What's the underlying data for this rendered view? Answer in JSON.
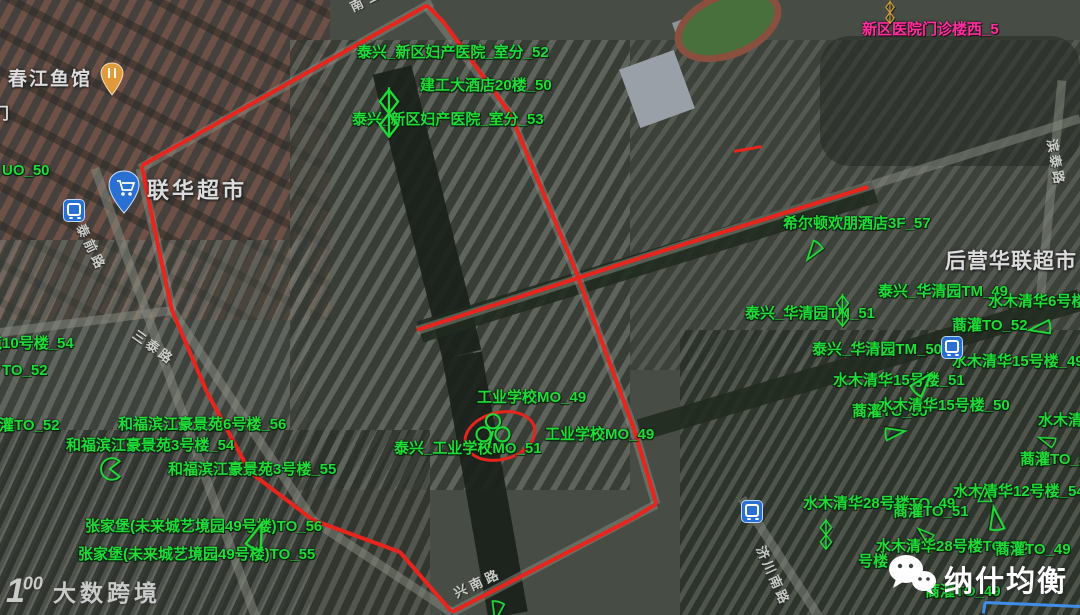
{
  "watermarks": {
    "bottom_left": {
      "logo": "1",
      "logo_sup": "00",
      "text": "大数跨境"
    },
    "bottom_right": {
      "icon": "wechat-icon",
      "text": "纳什均衡"
    }
  },
  "site_labels": [
    {
      "t": "泰兴_新区妇产医院_室分_52",
      "x": 357,
      "y": 45,
      "c": "g"
    },
    {
      "t": "建工大酒店20楼_50",
      "x": 420,
      "y": 78,
      "c": "g"
    },
    {
      "t": "泰兴_新区妇产医院_室分_53",
      "x": 352,
      "y": 112,
      "c": "g"
    },
    {
      "t": "新区医院门诊楼西_5",
      "x": 862,
      "y": 22,
      "c": "p"
    },
    {
      "t": "UO_50",
      "x": 2,
      "y": 163,
      "c": "g"
    },
    {
      "t": "苑10号楼_54",
      "x": -13,
      "y": 336,
      "c": "g"
    },
    {
      "t": "TO_52",
      "x": 2,
      "y": 363,
      "c": "g"
    },
    {
      "t": "蔏灌TO_52",
      "x": -16,
      "y": 418,
      "c": "g"
    },
    {
      "t": "和福滨江豪景苑6号楼_56",
      "x": 118,
      "y": 417,
      "c": "g"
    },
    {
      "t": "和福滨江豪景苑3号楼_54",
      "x": 66,
      "y": 438,
      "c": "g"
    },
    {
      "t": "和福滨江豪景苑3号楼_55",
      "x": 168,
      "y": 462,
      "c": "g"
    },
    {
      "t": "张家堡(未来城艺境园49号楼)TO_56",
      "x": 85,
      "y": 519,
      "c": "g"
    },
    {
      "t": "张家堡(未来城艺境园49号楼)TO_55",
      "x": 78,
      "y": 547,
      "c": "g"
    },
    {
      "t": "工业学校MO_49",
      "x": 477,
      "y": 390,
      "c": "g"
    },
    {
      "t": "工业学校MO_49",
      "x": 545,
      "y": 427,
      "c": "g"
    },
    {
      "t": "泰兴_工业学校MO_51",
      "x": 394,
      "y": 441,
      "c": "g"
    },
    {
      "t": "希尔顿欢朋酒店3F_57",
      "x": 783,
      "y": 216,
      "c": "g"
    },
    {
      "t": "泰兴_华清园TM_49",
      "x": 878,
      "y": 284,
      "c": "g"
    },
    {
      "t": "水木清华6号楼_49",
      "x": 988,
      "y": 294,
      "c": "g"
    },
    {
      "t": "泰兴_华清园TM_51",
      "x": 745,
      "y": 306,
      "c": "g"
    },
    {
      "t": "蔏灌TO_52",
      "x": 952,
      "y": 318,
      "c": "g"
    },
    {
      "t": "泰兴_华清园TM_50",
      "x": 812,
      "y": 342,
      "c": "g"
    },
    {
      "t": "水木清华15号楼_49",
      "x": 952,
      "y": 354,
      "c": "g"
    },
    {
      "t": "水木清华15号楼_51",
      "x": 833,
      "y": 373,
      "c": "g"
    },
    {
      "t": "蔏灌TO_50",
      "x": 852,
      "y": 404,
      "c": "g"
    },
    {
      "t": "水木清华15号楼_50",
      "x": 878,
      "y": 398,
      "c": "g"
    },
    {
      "t": "水木清华",
      "x": 1038,
      "y": 413,
      "c": "g"
    },
    {
      "t": "蔏灌TO_53",
      "x": 1020,
      "y": 452,
      "c": "g"
    },
    {
      "t": "水木清华12号楼_54",
      "x": 953,
      "y": 484,
      "c": "g"
    },
    {
      "t": "水木清华28号楼TO_49",
      "x": 803,
      "y": 496,
      "c": "g"
    },
    {
      "t": "蔏灌TO_51",
      "x": 893,
      "y": 504,
      "c": "g"
    },
    {
      "t": "水木清华28号楼TO_50",
      "x": 876,
      "y": 539,
      "c": "g"
    },
    {
      "t": "蔏灌TO_49",
      "x": 995,
      "y": 542,
      "c": "g"
    },
    {
      "t": "号楼",
      "x": 858,
      "y": 554,
      "c": "g"
    },
    {
      "t": "蔏灌TO_49",
      "x": 925,
      "y": 584,
      "c": "g"
    }
  ],
  "poi_labels": [
    {
      "t": "春江鱼馆",
      "x": 8,
      "y": 70,
      "fs": 19,
      "ls": 2
    },
    {
      "t": "门",
      "x": -7,
      "y": 106,
      "fs": 16,
      "ls": 0
    },
    {
      "t": "联华超市",
      "x": 147,
      "y": 179,
      "fs": 22,
      "ls": 3
    },
    {
      "t": "后营华联超市",
      "x": 945,
      "y": 250,
      "fs": 21,
      "ls": 1
    }
  ],
  "road_labels": [
    {
      "t": "南二环路",
      "x": 348,
      "y": 2,
      "rot": -26,
      "ls": 6
    },
    {
      "t": "泰前路",
      "x": 86,
      "y": 222,
      "rot": 64,
      "ls": 4
    },
    {
      "t": "三泰路",
      "x": 138,
      "y": 328,
      "rot": 36,
      "ls": 3
    },
    {
      "t": "兴南路",
      "x": 452,
      "y": 588,
      "rot": -25,
      "ls": 4
    },
    {
      "t": "济川南路",
      "x": 766,
      "y": 544,
      "rot": 66,
      "ls": 3
    },
    {
      "t": "滨泰路",
      "x": 1058,
      "y": 138,
      "rot": 80,
      "ls": 3
    }
  ],
  "route": {
    "color": "#e8251d",
    "loop": [
      [
        427,
        6
      ],
      [
        142,
        166
      ],
      [
        157,
        240
      ],
      [
        172,
        310
      ],
      [
        207,
        392
      ],
      [
        250,
        472
      ],
      [
        313,
        520
      ],
      [
        400,
        552
      ],
      [
        452,
        612
      ],
      [
        630,
        520
      ],
      [
        656,
        504
      ],
      [
        634,
        430
      ],
      [
        575,
        270
      ],
      [
        510,
        114
      ],
      [
        443,
        22
      ],
      [
        427,
        6
      ]
    ],
    "spur": [
      [
        417,
        330
      ],
      [
        640,
        258
      ],
      [
        868,
        187
      ]
    ],
    "tick": [
      [
        734,
        151
      ],
      [
        762,
        146
      ]
    ],
    "ellipse": {
      "cx": 497,
      "cy": 433,
      "rx": 34,
      "ry": 22,
      "rot": -14
    }
  },
  "measure_line": {
    "color": "#3f8fe8",
    "points": [
      [
        983,
        613
      ],
      [
        985,
        602
      ],
      [
        1080,
        606
      ]
    ]
  },
  "map_features": {
    "road_color": "rgba(138,142,132,0.5)",
    "water_color": "rgba(26,33,27,0.92)",
    "tree_color": "rgba(32,42,30,0.88)",
    "roads": [
      [
        [
          432,
          2
        ],
        [
          140,
          168
        ]
      ],
      [
        [
          140,
          168
        ],
        [
          172,
          310
        ]
      ],
      [
        [
          172,
          310
        ],
        [
          313,
          520
        ]
      ],
      [
        [
          313,
          520
        ],
        [
          452,
          612
        ]
      ],
      [
        [
          452,
          612
        ],
        [
          656,
          504
        ]
      ],
      [
        [
          427,
          6
        ],
        [
          510,
          114
        ]
      ],
      [
        [
          510,
          114
        ],
        [
          575,
          270
        ]
      ],
      [
        [
          575,
          270
        ],
        [
          634,
          430
        ]
      ],
      [
        [
          634,
          430
        ],
        [
          656,
          504
        ]
      ],
      [
        [
          417,
          330
        ],
        [
          1080,
          118
        ]
      ],
      [
        [
          95,
          168
        ],
        [
          255,
          615
        ]
      ],
      [
        [
          0,
          332
        ],
        [
          172,
          310
        ]
      ],
      [
        [
          742,
          498
        ],
        [
          818,
          615
        ]
      ],
      [
        [
          1062,
          80
        ],
        [
          1040,
          300
        ]
      ]
    ],
    "water": [
      [
        [
          392,
          70
        ],
        [
          462,
          355
        ]
      ],
      [
        [
          462,
          355
        ],
        [
          508,
          615
        ]
      ]
    ],
    "trees": [
      [
        [
          420,
          332
        ],
        [
          875,
          192
        ]
      ],
      [
        [
          640,
          430
        ],
        [
          1080,
          300
        ]
      ]
    ]
  },
  "site_icons": [
    {
      "type": "antenna",
      "x": 376,
      "y": 86,
      "h": 52
    },
    {
      "type": "clover",
      "x": 473,
      "y": 412,
      "h": 40
    },
    {
      "type": "sector",
      "x": 801,
      "y": 238,
      "h": 24,
      "rot": -15
    },
    {
      "type": "antenna",
      "x": 834,
      "y": 293,
      "h": 34
    },
    {
      "type": "sector",
      "x": 1028,
      "y": 314,
      "h": 26,
      "rot": 30
    },
    {
      "type": "sector",
      "x": 908,
      "y": 370,
      "h": 30,
      "rot": 170
    },
    {
      "type": "sector",
      "x": 882,
      "y": 422,
      "h": 24,
      "rot": 210
    },
    {
      "type": "triangle",
      "x": 975,
      "y": 484,
      "h": 20
    },
    {
      "type": "sector",
      "x": 983,
      "y": 506,
      "h": 28,
      "rot": 120
    },
    {
      "type": "sector",
      "x": 916,
      "y": 524,
      "h": 20,
      "rot": 80
    },
    {
      "type": "antenna",
      "x": 818,
      "y": 518,
      "h": 32
    },
    {
      "type": "sector",
      "x": 242,
      "y": 522,
      "h": 32,
      "rot": 150
    },
    {
      "type": "pacman",
      "x": 98,
      "y": 456,
      "h": 26
    },
    {
      "type": "sector",
      "x": 484,
      "y": 598,
      "h": 24,
      "rot": -40
    },
    {
      "type": "antenna",
      "x": 884,
      "y": 0,
      "h": 24,
      "color": "#dba13f"
    },
    {
      "type": "sector",
      "x": 1038,
      "y": 430,
      "h": 20,
      "rot": 60
    }
  ],
  "map_pins": [
    {
      "type": "cart-pin",
      "x": 108,
      "y": 170
    },
    {
      "type": "transit",
      "x": 63,
      "y": 199
    },
    {
      "type": "transit",
      "x": 941,
      "y": 336
    },
    {
      "type": "transit",
      "x": 741,
      "y": 500
    },
    {
      "type": "food-pin",
      "x": 100,
      "y": 62
    }
  ],
  "colors": {
    "site_green": "#1fdc38",
    "site_pink": "#ff2f9e",
    "route_red": "#e8251d",
    "pin_blue": "#2a6fd2"
  }
}
